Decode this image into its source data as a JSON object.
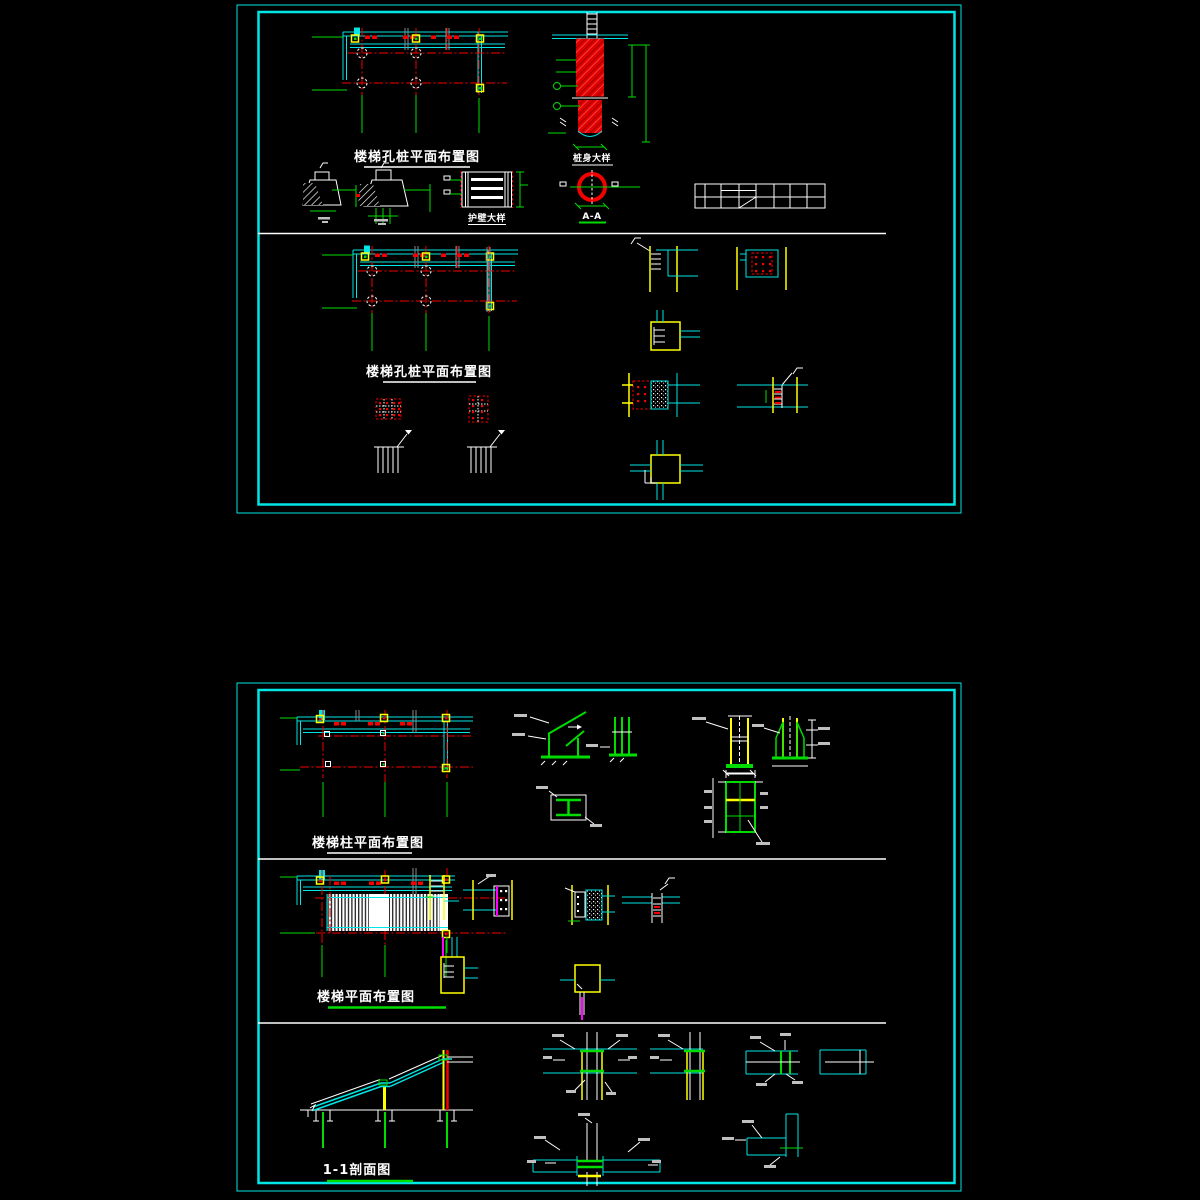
{
  "colors": {
    "background": "#000000",
    "frame_cyan": "#00e5e5",
    "grid_red": "#f40000",
    "dimension_green": "#00dc00",
    "column_yellow": "#ffff00",
    "line_white": "#ffffff",
    "accent_magenta": "#ff00ff",
    "secondary_gray": "#8a8a8a"
  },
  "sheet1": {
    "upper_plan_title": "楼梯孔桩平面布置图",
    "lower_plan_title": "楼梯孔桩平面布置图",
    "pile_detail_label": "桩身大样",
    "wall_lining_label": "护壁大样",
    "section_label": "A-A"
  },
  "sheet2": {
    "column_plan_title": "楼梯柱平面布置图",
    "stair_plan_title": "楼梯平面布置图",
    "section_title": "1-1剖面图"
  }
}
